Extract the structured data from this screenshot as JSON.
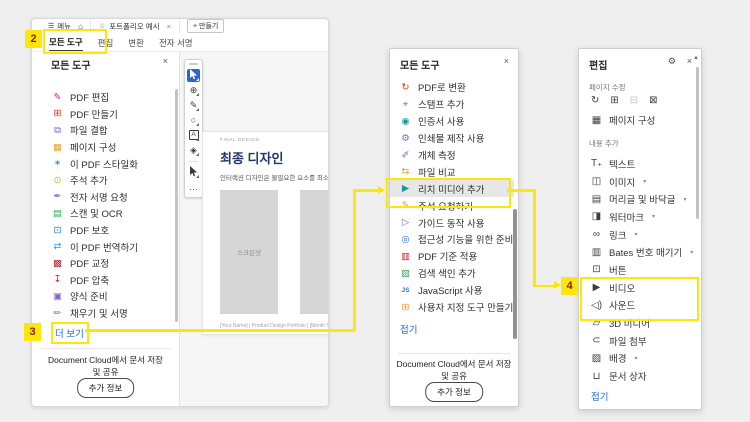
{
  "annotations": {
    "step2": "2",
    "step3": "3",
    "step4": "4",
    "highlight_color": "#FFE60A",
    "badge_text_color": "#8A1F05"
  },
  "colors": {
    "link_blue": "#1868DE",
    "active_tool_blue": "#2B62D9",
    "selected_row": "#E7E7E7"
  },
  "window": {
    "menu": {
      "hamburger": "☰",
      "menu_label": "메뉴",
      "home_glyph": "⌂",
      "star_glyph": "☆",
      "doc_tab_title": "포트폴리오 예시",
      "close_glyph": "×",
      "new_tab_label": "+ 만들기"
    },
    "tool_tabs": [
      {
        "label": "모든 도구",
        "active": true
      },
      {
        "label": "편집"
      },
      {
        "label": "변환"
      },
      {
        "label": "전자 서명"
      }
    ],
    "left_panel": {
      "title": "모든 도구",
      "close_glyph": "×",
      "items": [
        {
          "name": "edit-pdf",
          "glyph": "✎",
          "color": "#D6246E",
          "label": "PDF 편집"
        },
        {
          "name": "create-pdf",
          "glyph": "⊞",
          "color": "#E3350F",
          "label": "PDF 만들기"
        },
        {
          "name": "combine-files",
          "glyph": "⧉",
          "color": "#8A63D2",
          "label": "파일 결합"
        },
        {
          "name": "organize-pages",
          "glyph": "▦",
          "color": "#E8A13A",
          "label": "페이지 구성"
        },
        {
          "name": "stylize-pdf",
          "glyph": "✶",
          "color": "#2D9BF0",
          "label": "이 PDF 스타일화"
        },
        {
          "name": "add-comments",
          "glyph": "⊙",
          "color": "#E0A52E",
          "label": "주석 추가"
        },
        {
          "name": "request-esign",
          "glyph": "✒",
          "color": "#8A63D2",
          "label": "전자 서명 요청"
        },
        {
          "name": "scan-ocr",
          "glyph": "▤",
          "color": "#3DA860",
          "label": "스캔 및 OCR"
        },
        {
          "name": "protect-pdf",
          "glyph": "⊡",
          "color": "#2D77C9",
          "label": "PDF 보호"
        },
        {
          "name": "translate-pdf",
          "glyph": "⇄",
          "color": "#2D9BF0",
          "label": "이 PDF 번역하기"
        },
        {
          "name": "redact-pdf",
          "glyph": "▩",
          "color": "#C9252D",
          "label": "PDF 교정"
        },
        {
          "name": "compress-pdf",
          "glyph": "↧",
          "color": "#C9252D",
          "label": "PDF 압축"
        },
        {
          "name": "prepare-form",
          "glyph": "▣",
          "color": "#8A63D2",
          "label": "양식 준비"
        },
        {
          "name": "fill-sign",
          "glyph": "✏",
          "color": "#8A63D2",
          "label": "채우기 및 서명"
        }
      ],
      "more_link": "더 보기",
      "cloud_line1": "Document Cloud에서 문서 저장",
      "cloud_line2": "및 공유",
      "info_button": "추가 정보"
    },
    "doc_toolbar": {
      "zoom_glyph": "⊕",
      "pen_glyph": "✎",
      "lasso_glyph": "○",
      "textbox_glyph": "A",
      "stamp_glyph": "◈",
      "more_glyph": "…"
    },
    "document": {
      "eyebrow": "FINAL DESIGN",
      "title": "최종 디자인",
      "body": "인터랙션 디자인은 불필요한 요소를 최소화하고",
      "placeholder": "스크린샷",
      "footer": "[Your Name]  |  Product Design Portfolio  |  [Month Year]"
    }
  },
  "middle_panel": {
    "title": "모든 도구",
    "close_glyph": "×",
    "items": [
      {
        "name": "convert-to-pdf",
        "glyph": "↻",
        "color": "#E3350F",
        "label": "PDF로 변환"
      },
      {
        "name": "add-stamp",
        "glyph": "⌖",
        "color": "#8A63D2",
        "label": "스탬프 추가"
      },
      {
        "name": "use-certificate",
        "glyph": "◉",
        "color": "#18989D",
        "label": "인증서 사용"
      },
      {
        "name": "print-production",
        "glyph": "⚙",
        "color": "#8A63D2",
        "label": "인쇄물 제작 사용"
      },
      {
        "name": "measure-objects",
        "glyph": "✐",
        "color": "#8A63D2",
        "label": "개체 측정"
      },
      {
        "name": "compare-files",
        "glyph": "⇆",
        "color": "#E0A52E",
        "label": "파일 비교"
      },
      {
        "name": "add-rich-media",
        "glyph": "▶",
        "color": "#18989D",
        "label": "리치 미디어 추가",
        "selected": true
      },
      {
        "name": "request-comments",
        "glyph": "✎",
        "color": "#E0A52E",
        "label": "주석 요청하기"
      },
      {
        "name": "guided-actions",
        "glyph": "▷",
        "color": "#8A63D2",
        "label": "가이드 동작 사용"
      },
      {
        "name": "accessibility-prep",
        "glyph": "◎",
        "color": "#2D77C9",
        "label": "접근성 기능을 위한 준비"
      },
      {
        "name": "pdf-standards",
        "glyph": "▥",
        "color": "#C9252D",
        "label": "PDF 기준 적용"
      },
      {
        "name": "search-index",
        "glyph": "▧",
        "color": "#3DA860",
        "label": "검색 색인 추가"
      },
      {
        "name": "use-javascript",
        "glyph": "JS",
        "color": "#2D77C9",
        "label": "JavaScript 사용",
        "small": true
      },
      {
        "name": "custom-tool",
        "glyph": "⊞",
        "color": "#E8A13A",
        "label": "사용자 지정 도구 만들기"
      }
    ],
    "collapse_link": "접기",
    "cloud_line1": "Document Cloud에서 문서 저장",
    "cloud_line2": "및 공유",
    "info_button": "추가 정보"
  },
  "right_panel": {
    "title": "편집",
    "gear_glyph": "⚙",
    "close_glyph": "×",
    "scroll_up_glyph": "▲",
    "section_pages": "페이지 수정",
    "page_icons": [
      {
        "name": "rotate-pages-icon",
        "glyph": "↻"
      },
      {
        "name": "insert-pages-icon",
        "glyph": "⊞"
      },
      {
        "name": "delete-pages-icon",
        "glyph": "⊟",
        "disabled": true
      },
      {
        "name": "extract-pages-icon",
        "glyph": "⊠"
      }
    ],
    "organize_item": {
      "name": "organize-pages",
      "glyph": "▦",
      "label": "페이지 구성"
    },
    "section_content": "내용 추가",
    "items": [
      {
        "name": "add-text",
        "glyph": "T₊",
        "label": "텍스트"
      },
      {
        "name": "add-image",
        "glyph": "◫",
        "label": "이미지",
        "dropdown": true
      },
      {
        "name": "header-footer",
        "glyph": "▤",
        "label": "머리글 및 바닥글",
        "dropdown": true
      },
      {
        "name": "watermark",
        "glyph": "◨",
        "label": "워터마크",
        "dropdown": true
      },
      {
        "name": "link",
        "glyph": "∞",
        "label": "링크",
        "dropdown": true
      },
      {
        "name": "bates-numbering",
        "glyph": "▥",
        "label": "Bates 번호 매기기",
        "dropdown": true
      },
      {
        "name": "button",
        "glyph": "⊡",
        "label": "버튼"
      },
      {
        "name": "video",
        "glyph": "▶",
        "label": "비디오"
      },
      {
        "name": "sound",
        "glyph": "◁)",
        "label": "사운드"
      },
      {
        "name": "3d-media",
        "glyph": "▱",
        "label": "3D 미디어"
      },
      {
        "name": "attach-file",
        "glyph": "⊂",
        "label": "파일 첨부"
      },
      {
        "name": "background",
        "glyph": "▨",
        "label": "배경",
        "dropdown": true
      },
      {
        "name": "document-box",
        "glyph": "⊔",
        "label": "문서 상자"
      }
    ],
    "collapse_link": "접기"
  }
}
